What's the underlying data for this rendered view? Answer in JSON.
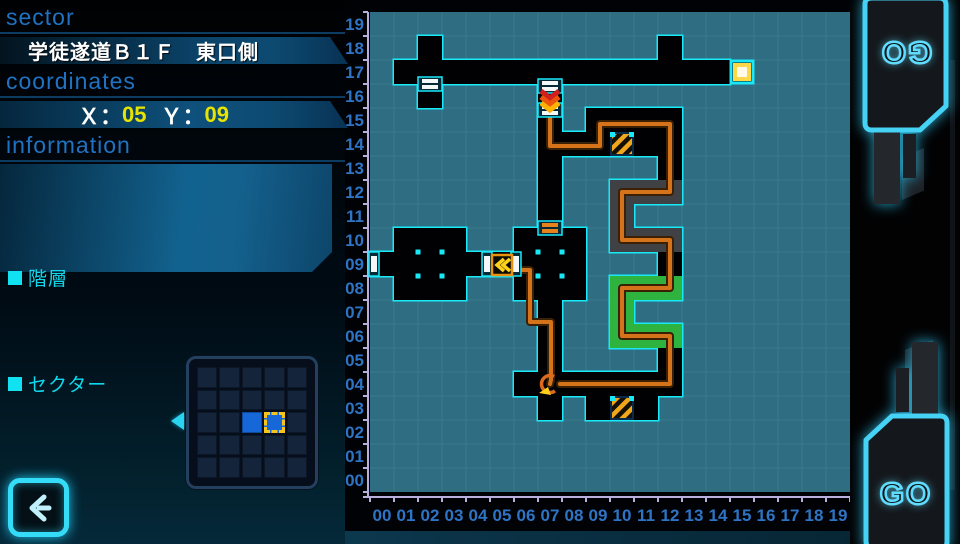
{
  "left_panel": {
    "sector_header": "sector",
    "sector_title": "学徒遂道Ｂ１Ｆ　東口側",
    "coordinates_header": "coordinates",
    "coord_x_label": "Ｘ：",
    "coord_x_value": "05",
    "coord_y_label": "Ｙ：",
    "coord_y_value": "09",
    "information_header": "information",
    "floor_label": "階層",
    "sector_label": "セクター"
  },
  "buttons": {
    "go_top": "GO",
    "go_bottom": "GO"
  },
  "minimap": {
    "rows": 5,
    "cols": 5,
    "filled_cells": [
      [
        2,
        2
      ]
    ],
    "selected_cell": [
      2,
      3
    ],
    "accent_fill": "#1668d8",
    "selection_color": "#f5c51d"
  },
  "map": {
    "origin": [
      370,
      12
    ],
    "cell_size": 24,
    "cols": 20,
    "rows": 20,
    "player_position": {
      "x": "05",
      "y": "09"
    },
    "x_labels": [
      "00",
      "01",
      "02",
      "03",
      "04",
      "05",
      "06",
      "07",
      "08",
      "09",
      "10",
      "11",
      "12",
      "13",
      "14",
      "15",
      "16",
      "17",
      "18",
      "19"
    ],
    "y_labels": [
      "19",
      "18",
      "17",
      "16",
      "15",
      "14",
      "13",
      "12",
      "11",
      "10",
      "09",
      "08",
      "07",
      "06",
      "05",
      "04",
      "03",
      "02",
      "01",
      "00"
    ],
    "colors": {
      "water": "#2f6e82",
      "grid": "rgba(190,230,235,0.09)",
      "outline": "#19e8f8",
      "dark": "#010104",
      "gray": "#404144",
      "green": "#2db33e",
      "axis_line": "#b9aede",
      "axis_text": "#2e74c4",
      "route": "#d4731a",
      "route_rim": "#3a2004",
      "hazard_orange": "#f0a71b",
      "hazard_dark": "#151005",
      "door_white": "#f4f8f8",
      "door_orange": "#e8821a",
      "exit_yellow": "#ffd84a",
      "event_yellow": "#ffd11a",
      "player_orange": "#dd6a1d"
    },
    "blocks": [
      {
        "c": 2,
        "r": 18,
        "w": 1,
        "h": 1,
        "k": "dark"
      },
      {
        "c": 12,
        "r": 18,
        "w": 1,
        "h": 1,
        "k": "dark"
      },
      {
        "c": 1,
        "r": 17,
        "w": 14,
        "h": 1,
        "k": "dark"
      },
      {
        "c": 2,
        "r": 16,
        "w": 1,
        "h": 1,
        "k": "dark"
      },
      {
        "c": 7,
        "r": 11,
        "w": 1,
        "h": 6,
        "k": "dark"
      },
      {
        "c": 9,
        "r": 15,
        "w": 4,
        "h": 1,
        "k": "dark"
      },
      {
        "c": 7,
        "r": 14,
        "w": 3,
        "h": 1,
        "k": "dark"
      },
      {
        "c": 10,
        "r": 14,
        "w": 3,
        "h": 1,
        "k": "dark"
      },
      {
        "c": 12,
        "r": 13,
        "w": 1,
        "h": 1,
        "k": "dark"
      },
      {
        "c": 10,
        "r": 12,
        "w": 3,
        "h": 1,
        "k": "gray"
      },
      {
        "c": 10,
        "r": 10,
        "w": 1,
        "h": 3,
        "k": "gray"
      },
      {
        "c": 10,
        "r": 10,
        "w": 3,
        "h": 1,
        "k": "gray"
      },
      {
        "c": 12,
        "r": 9,
        "w": 1,
        "h": 1,
        "k": "dark"
      },
      {
        "c": 10,
        "r": 8,
        "w": 3,
        "h": 1,
        "k": "green"
      },
      {
        "c": 10,
        "r": 6,
        "w": 1,
        "h": 3,
        "k": "green"
      },
      {
        "c": 10,
        "r": 6,
        "w": 3,
        "h": 1,
        "k": "green"
      },
      {
        "c": 12,
        "r": 4,
        "w": 1,
        "h": 2,
        "k": "dark"
      },
      {
        "c": 6,
        "r": 4,
        "w": 7,
        "h": 1,
        "k": "dark"
      },
      {
        "c": 7,
        "r": 5,
        "w": 1,
        "h": 3,
        "k": "dark"
      },
      {
        "c": 7,
        "r": 3,
        "w": 1,
        "h": 1,
        "k": "dark"
      },
      {
        "c": 9,
        "r": 3,
        "w": 3,
        "h": 1,
        "k": "dark"
      },
      {
        "c": 1,
        "r": 8,
        "w": 3,
        "h": 3,
        "k": "dark"
      },
      {
        "c": 6,
        "r": 8,
        "w": 3,
        "h": 3,
        "k": "dark"
      },
      {
        "c": 0,
        "r": 9,
        "w": 1,
        "h": 1,
        "k": "dark"
      },
      {
        "c": 4,
        "r": 9,
        "w": 1,
        "h": 1,
        "k": "dark"
      },
      {
        "c": 5,
        "r": 9,
        "w": 1,
        "h": 1,
        "k": "dark"
      }
    ],
    "hazard_tiles": [
      [
        10,
        14
      ],
      [
        10,
        3
      ]
    ],
    "exit_tile": [
      15,
      17
    ],
    "room_dots": [
      [
        418,
        252
      ],
      [
        442,
        252
      ],
      [
        418,
        276
      ],
      [
        442,
        276
      ],
      [
        538,
        252
      ],
      [
        562,
        252
      ],
      [
        538,
        276
      ],
      [
        562,
        276
      ]
    ],
    "doors": [
      {
        "cx": 430,
        "cy": 84,
        "o": "h",
        "col": "white"
      },
      {
        "cx": 550,
        "cy": 86,
        "o": "h",
        "col": "white"
      },
      {
        "cx": 550,
        "cy": 110,
        "o": "h",
        "col": "white"
      },
      {
        "cx": 550,
        "cy": 228,
        "o": "h",
        "col": "orange"
      },
      {
        "cx": 374,
        "cy": 264,
        "o": "v",
        "col": "white"
      },
      {
        "cx": 487,
        "cy": 264,
        "o": "v",
        "col": "white"
      },
      {
        "cx": 516,
        "cy": 264,
        "o": "v",
        "col": "white"
      }
    ],
    "routes": {
      "a": [
        [
          550,
          106
        ],
        [
          550,
          146
        ],
        [
          600,
          146
        ],
        [
          600,
          124
        ],
        [
          670,
          124
        ],
        [
          670,
          192
        ],
        [
          622,
          192
        ],
        [
          622,
          240
        ],
        [
          670,
          240
        ],
        [
          670,
          288
        ],
        [
          622,
          288
        ],
        [
          622,
          336
        ],
        [
          670,
          336
        ],
        [
          670,
          384
        ],
        [
          560,
          384
        ]
      ],
      "b": [
        [
          512,
          270
        ],
        [
          530,
          270
        ],
        [
          530,
          322
        ],
        [
          551,
          322
        ],
        [
          551,
          380
        ],
        [
          550,
          384
        ]
      ]
    },
    "stairs_icon": {
      "cx": 550,
      "cy": 96
    },
    "player_icon": {
      "cx": 550,
      "cy": 384
    },
    "event_box": {
      "x": 492,
      "y": 255,
      "size": 20
    }
  }
}
